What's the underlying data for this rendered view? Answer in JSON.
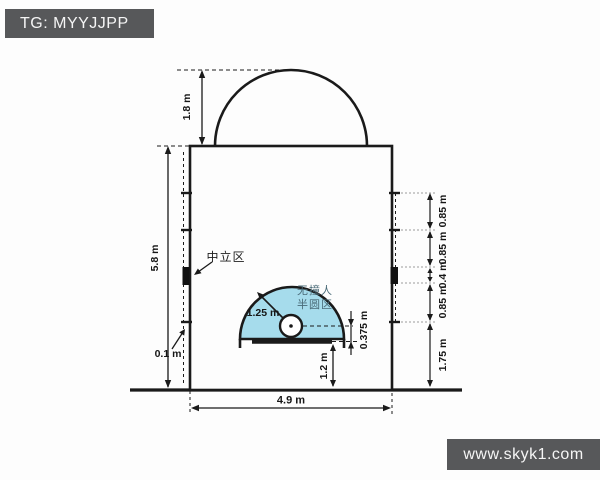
{
  "watermarks": {
    "top_left": "TG: MYYJJPP",
    "bottom_right": "www.skyk1.com"
  },
  "diagram": {
    "subject": "basketball free-throw lane (restricted area) dimensions",
    "labels": {
      "semicircle_radius": "1.8 m",
      "lane_height": "5.8 m",
      "hash_mark_length": "0.1 m",
      "lane_width": "4.9 m",
      "neutral_zone": "中立区",
      "no_charge_line1": "无撞人",
      "no_charge_line2": "半圆区",
      "no_charge_radius": "1.25 m",
      "ring_to_backboard": "0.375 m",
      "backboard_to_baseline": "1.2 m",
      "right_chain": [
        "0.85 m",
        "0.85 m",
        "0.4 m",
        "0.85 m",
        "1.75 m"
      ]
    },
    "colors": {
      "line": "#1a1a1a",
      "no_charge_fill": "#a6dcec",
      "zone_text": "#4a6b78",
      "watermark_bg": "#57585a"
    }
  }
}
